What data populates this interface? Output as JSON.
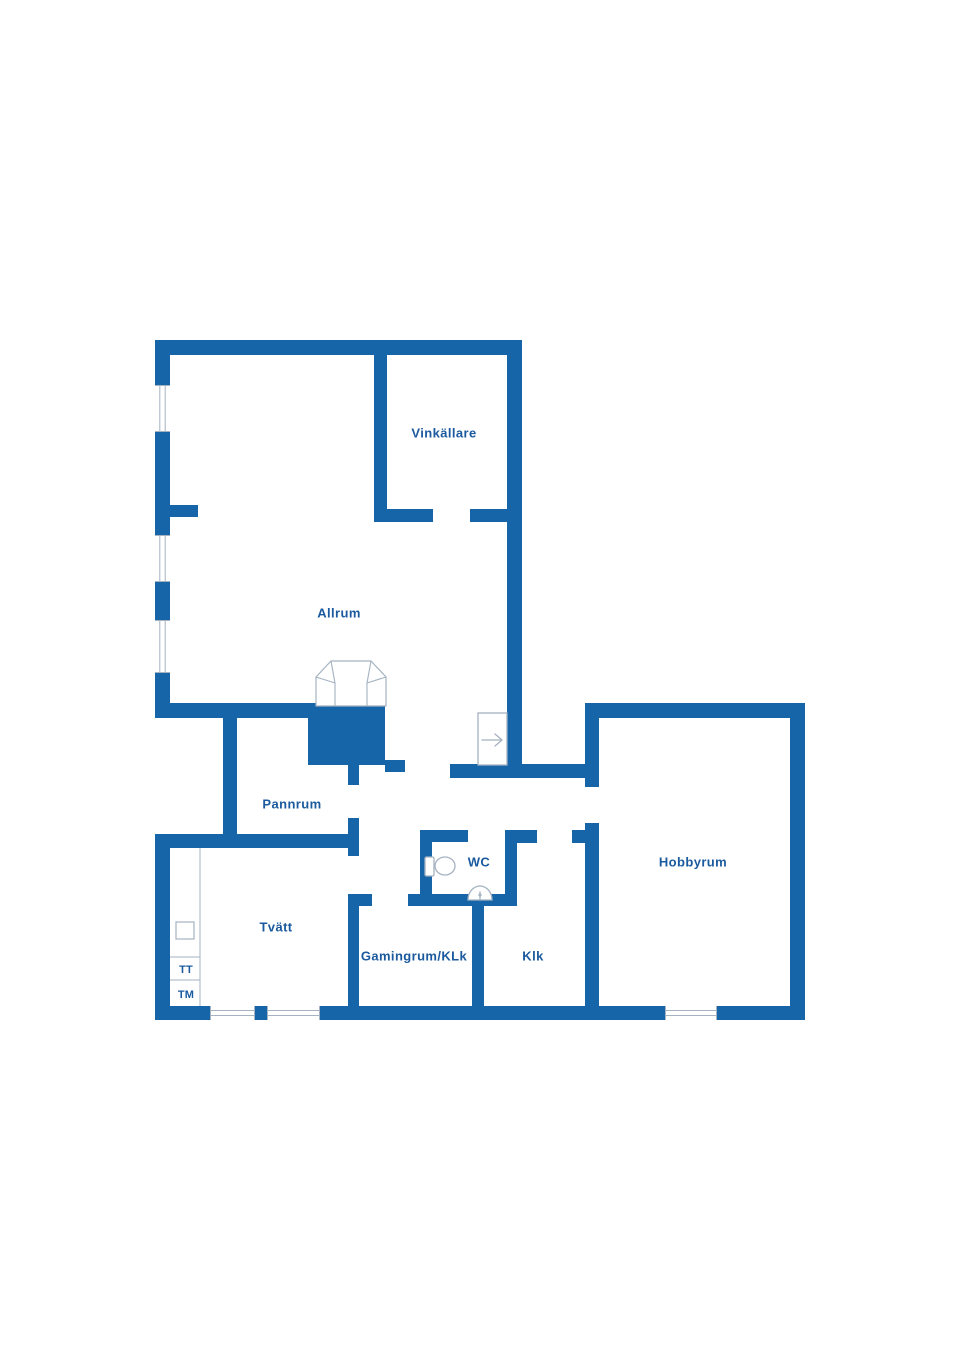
{
  "page": {
    "background": "#ffffff"
  },
  "colors": {
    "wall": "#1565a8",
    "label": "#1b5a9e",
    "fixture": "#a5b2c1",
    "window_line": "#a5b2c1",
    "room_fill": "#ffffff"
  },
  "floor_plan": {
    "canvas": {
      "width": 960,
      "height": 1358
    },
    "rooms": [
      {
        "id": "vinkallare",
        "label": "Vinkällare",
        "x": 444,
        "y": 434,
        "size": 13
      },
      {
        "id": "allrum",
        "label": "Allrum",
        "x": 339,
        "y": 614,
        "size": 13
      },
      {
        "id": "pannrum",
        "label": "Pannrum",
        "x": 292,
        "y": 805,
        "size": 13
      },
      {
        "id": "wc",
        "label": "WC",
        "x": 479,
        "y": 863,
        "size": 13
      },
      {
        "id": "hobbyrum",
        "label": "Hobbyrum",
        "x": 693,
        "y": 863,
        "size": 13
      },
      {
        "id": "tvatt",
        "label": "Tvätt",
        "x": 276,
        "y": 928,
        "size": 13
      },
      {
        "id": "gamingrum-klk",
        "label": "Gamingrum/KLk",
        "x": 414,
        "y": 957,
        "size": 13
      },
      {
        "id": "klk",
        "label": "Klk",
        "x": 533,
        "y": 957,
        "size": 13
      }
    ],
    "appliances": [
      {
        "id": "tt",
        "label": "TT",
        "x": 186,
        "y": 970,
        "size": 11
      },
      {
        "id": "tm",
        "label": "TM",
        "x": 186,
        "y": 995,
        "size": 11
      }
    ],
    "walls": [
      {
        "name": "outer-top",
        "x": 155,
        "y": 340,
        "w": 365,
        "h": 15
      },
      {
        "name": "outer-left-upper",
        "x": 155,
        "y": 340,
        "w": 15,
        "h": 378
      },
      {
        "name": "allrum-bottom-left",
        "x": 155,
        "y": 703,
        "w": 155,
        "h": 15
      },
      {
        "name": "pannrum-left",
        "x": 223,
        "y": 703,
        "w": 14,
        "h": 145
      },
      {
        "name": "tvatt-top",
        "x": 155,
        "y": 834,
        "w": 200,
        "h": 14
      },
      {
        "name": "outer-left-lower",
        "x": 155,
        "y": 834,
        "w": 15,
        "h": 186
      },
      {
        "name": "outer-bottom",
        "x": 155,
        "y": 1006,
        "w": 650,
        "h": 14
      },
      {
        "name": "outer-right-wing",
        "x": 790,
        "y": 703,
        "w": 15,
        "h": 317
      },
      {
        "name": "hobbyrum-top",
        "x": 585,
        "y": 703,
        "w": 220,
        "h": 15
      },
      {
        "name": "allrum-right",
        "x": 507,
        "y": 340,
        "w": 15,
        "h": 438
      },
      {
        "name": "vinkallare-left",
        "x": 374,
        "y": 355,
        "w": 13,
        "h": 156
      },
      {
        "name": "vinkallare-bottom-left",
        "x": 374,
        "y": 509,
        "w": 59,
        "h": 13
      },
      {
        "name": "vinkallare-bottom-right",
        "x": 470,
        "y": 509,
        "w": 50,
        "h": 13
      },
      {
        "name": "allrum-left-stub",
        "x": 170,
        "y": 505,
        "w": 28,
        "h": 12
      },
      {
        "name": "fireplace-hearth",
        "x": 308,
        "y": 703,
        "w": 77,
        "h": 62
      },
      {
        "name": "hearth-right-stub",
        "x": 385,
        "y": 760,
        "w": 20,
        "h": 12
      },
      {
        "name": "hearth-below-stub",
        "x": 348,
        "y": 765,
        "w": 11,
        "h": 20
      },
      {
        "name": "hall-bottom-wall",
        "x": 450,
        "y": 764,
        "w": 149,
        "h": 14
      },
      {
        "name": "hobbyrum-left-upper",
        "x": 585,
        "y": 703,
        "w": 14,
        "h": 84
      },
      {
        "name": "hobbyrum-left-lower",
        "x": 585,
        "y": 823,
        "w": 14,
        "h": 190
      },
      {
        "name": "klk-top-stub",
        "x": 572,
        "y": 830,
        "w": 27,
        "h": 13
      },
      {
        "name": "pannrum-right-lower",
        "x": 348,
        "y": 818,
        "w": 11,
        "h": 38
      },
      {
        "name": "tvatt-gaming-divider",
        "x": 348,
        "y": 894,
        "w": 11,
        "h": 118
      },
      {
        "name": "gaming-door-stub",
        "x": 359,
        "y": 894,
        "w": 13,
        "h": 12
      },
      {
        "name": "wc-bottom",
        "x": 408,
        "y": 894,
        "w": 109,
        "h": 12
      },
      {
        "name": "wc-left",
        "x": 420,
        "y": 830,
        "w": 12,
        "h": 76
      },
      {
        "name": "wc-top",
        "x": 420,
        "y": 830,
        "w": 48,
        "h": 12
      },
      {
        "name": "wc-top-right",
        "x": 505,
        "y": 830,
        "w": 32,
        "h": 13
      },
      {
        "name": "wc-right",
        "x": 505,
        "y": 830,
        "w": 12,
        "h": 76
      },
      {
        "name": "gaming-klk-divider",
        "x": 472,
        "y": 894,
        "w": 12,
        "h": 120
      }
    ],
    "windows": [
      {
        "x": 155,
        "y": 385,
        "w": 15,
        "h": 47,
        "dir": "v"
      },
      {
        "x": 155,
        "y": 535,
        "w": 15,
        "h": 47,
        "dir": "v"
      },
      {
        "x": 155,
        "y": 620,
        "w": 15,
        "h": 53,
        "dir": "v"
      },
      {
        "x": 210,
        "y": 1006,
        "w": 45,
        "h": 14,
        "dir": "h"
      },
      {
        "x": 267,
        "y": 1006,
        "w": 53,
        "h": 14,
        "dir": "h"
      },
      {
        "x": 665,
        "y": 1006,
        "w": 52,
        "h": 14,
        "dir": "h"
      }
    ],
    "stairs": {
      "x": 478,
      "y": 713,
      "w": 29,
      "h": 52,
      "arrow": {
        "x1": 482,
        "x2": 502,
        "y": 740
      }
    },
    "fireplace": {
      "outer": "316,706 316,677 331,661 371,661 386,677 386,706",
      "inner_lines": [
        [
          316,
          677,
          335,
          683
        ],
        [
          331,
          661,
          335,
          683
        ],
        [
          335,
          683,
          335,
          706
        ],
        [
          386,
          677,
          367,
          683
        ],
        [
          371,
          661,
          367,
          683
        ],
        [
          367,
          683,
          367,
          706
        ]
      ]
    },
    "toilet": {
      "tank": {
        "x": 425,
        "y": 857,
        "w": 9,
        "h": 19
      },
      "bowl": {
        "cx": 445,
        "cy": 866,
        "rx": 10,
        "ry": 9
      }
    },
    "sink": {
      "cx": 480,
      "cy": 900,
      "rx": 12,
      "ry": 14
    },
    "closet": {
      "line_x": 200,
      "y1": 848,
      "y2": 1006,
      "left_x": 170,
      "dividers": [
        957,
        980
      ],
      "box": {
        "x": 176,
        "y": 922,
        "w": 18,
        "h": 17
      }
    }
  }
}
